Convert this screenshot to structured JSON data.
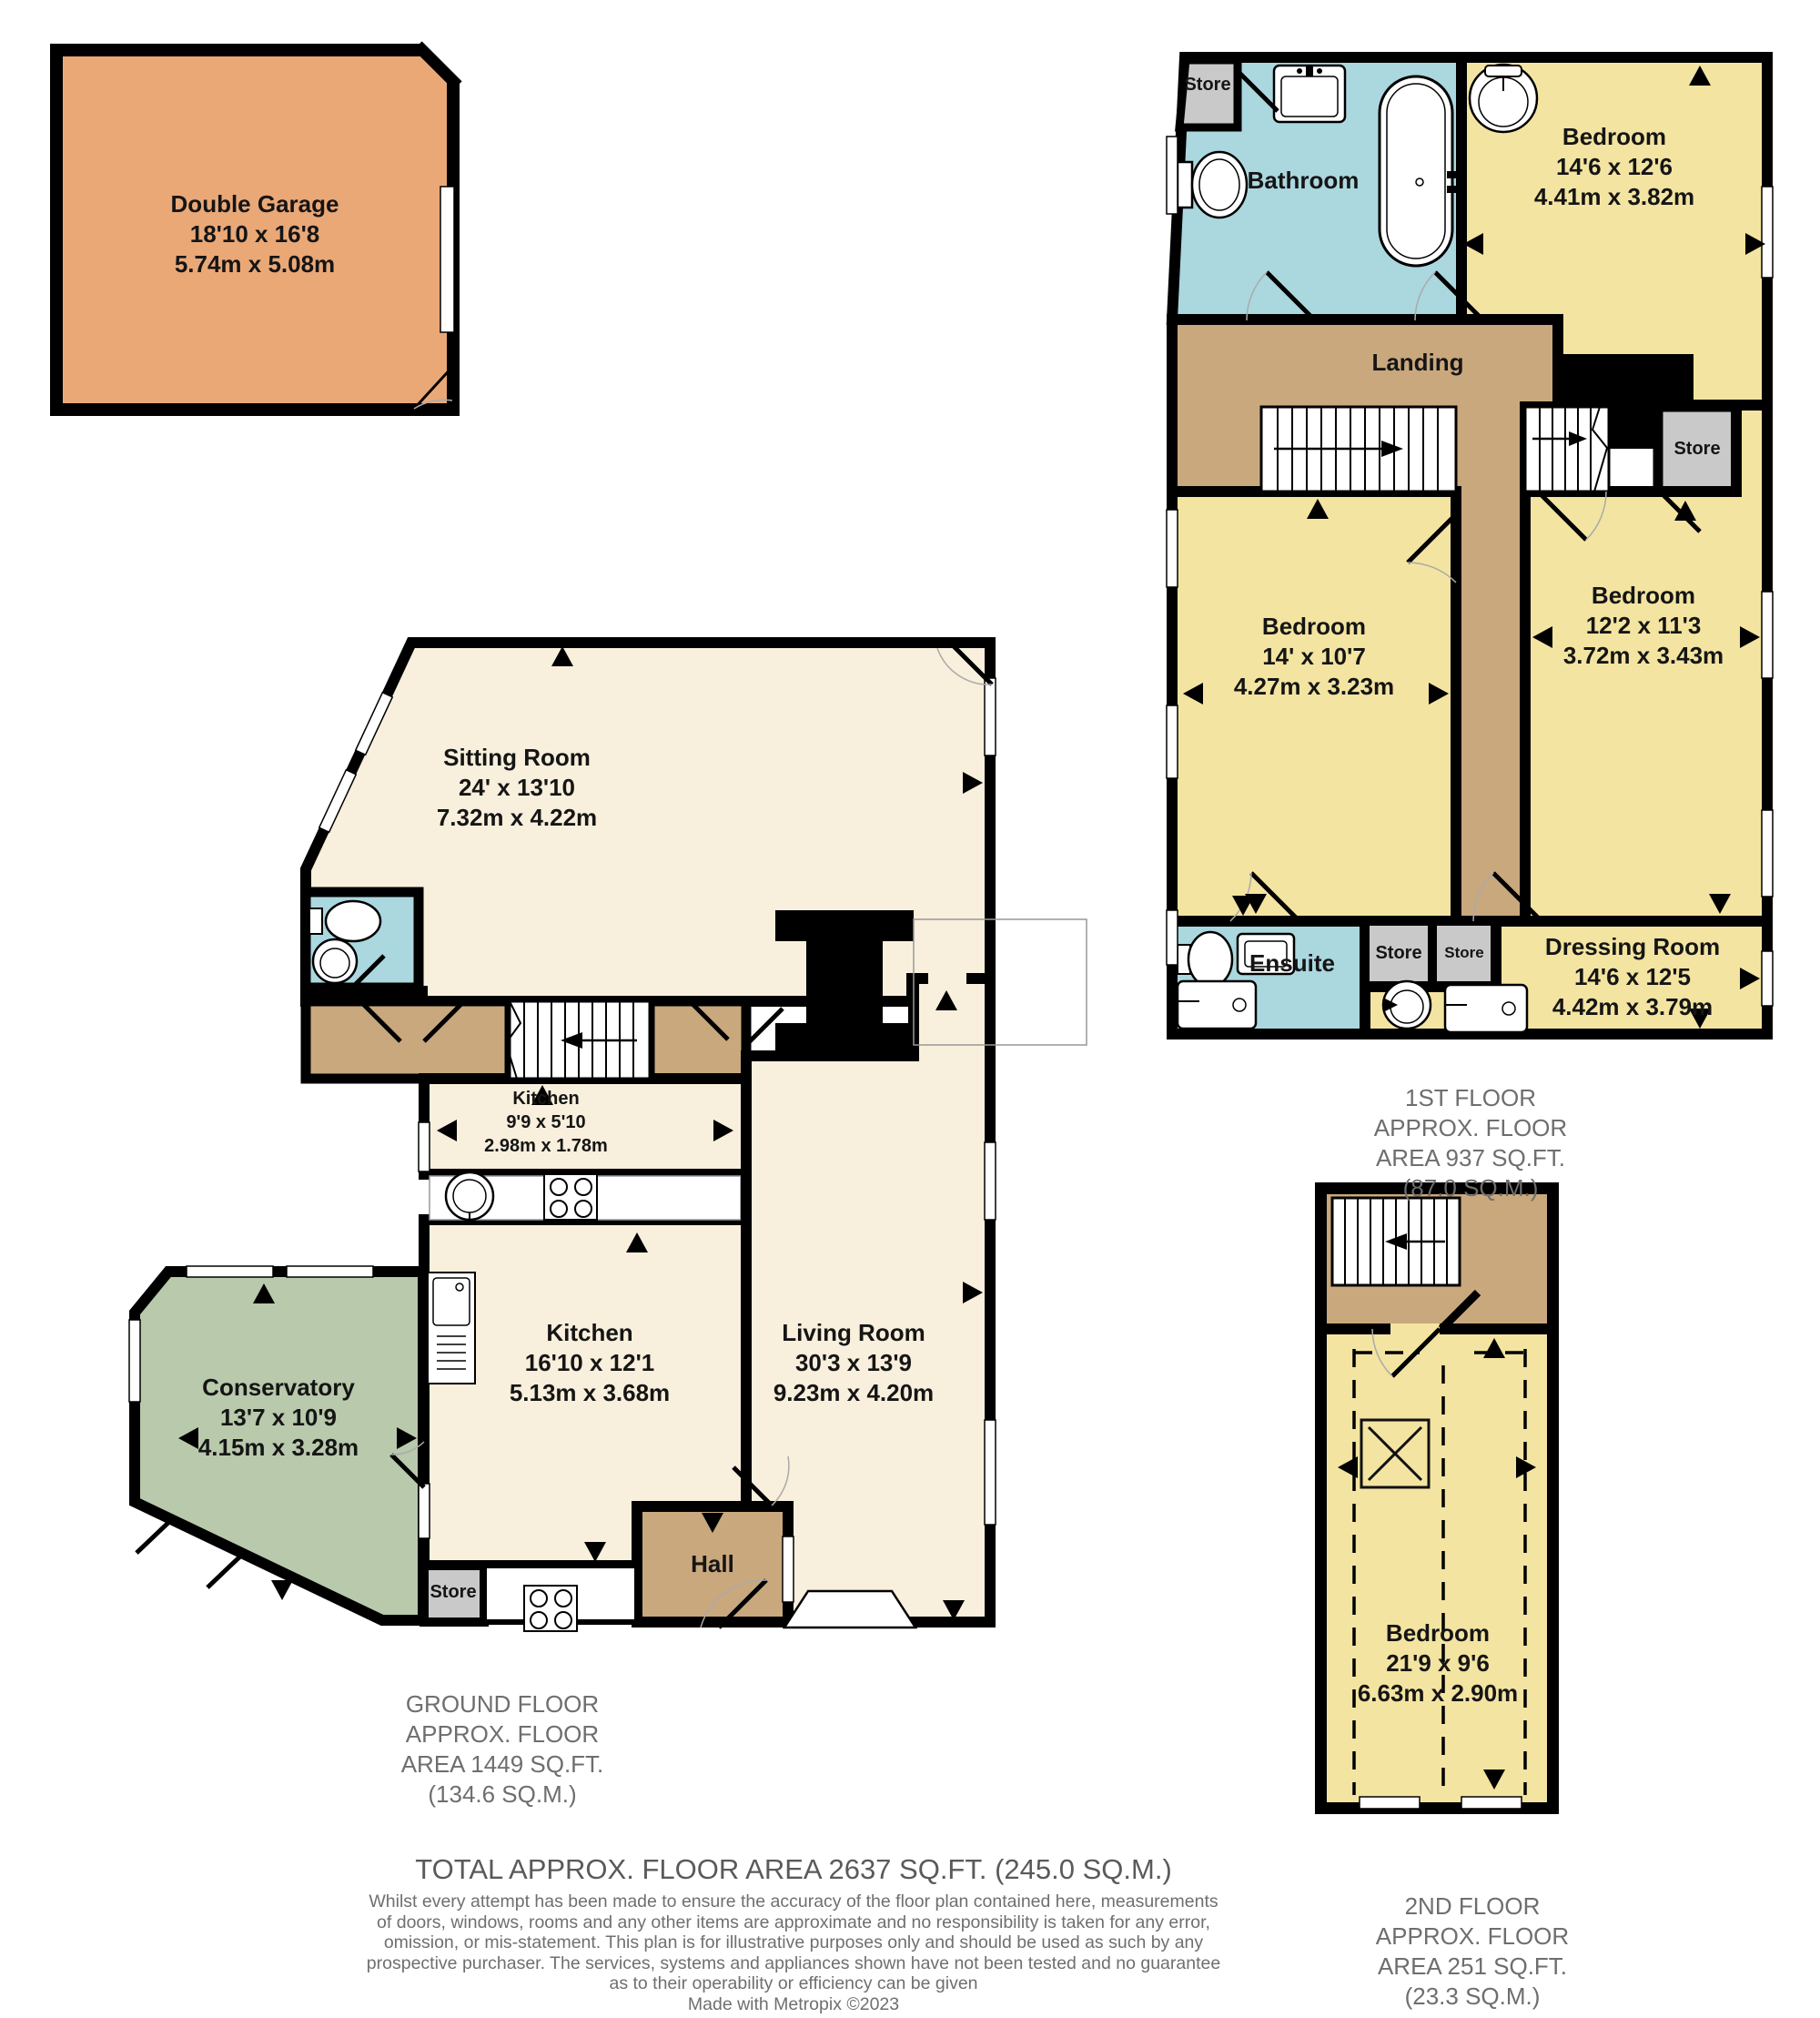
{
  "garage": {
    "name": "Double Garage",
    "imperial": "18'10 x 16'8",
    "metric": "5.74m x 5.08m"
  },
  "first_floor": {
    "caption": [
      "1ST FLOOR",
      "APPROX. FLOOR",
      "AREA 937 SQ.FT.",
      "(87.0 SQ.M.)"
    ],
    "rooms": {
      "store_top": {
        "name": "Store"
      },
      "bathroom": {
        "name": "Bathroom"
      },
      "bedroom_front": {
        "name": "Bedroom",
        "imperial": "14'6 x 12'6",
        "metric": "4.41m x 3.82m"
      },
      "landing": {
        "name": "Landing"
      },
      "store_landing": {
        "name": "Store"
      },
      "bedroom_left": {
        "name": "Bedroom",
        "imperial": "14' x 10'7",
        "metric": "4.27m x 3.23m"
      },
      "bedroom_right": {
        "name": "Bedroom",
        "imperial": "12'2 x 11'3",
        "metric": "3.72m x 3.43m"
      },
      "ensuite": {
        "name": "Ensuite"
      },
      "store_small_1": {
        "name": "Store"
      },
      "store_small_2": {
        "name": "Store"
      },
      "dressing_room": {
        "name": "Dressing Room",
        "imperial": "14'6 x 12'5",
        "metric": "4.42m x 3.79m"
      }
    }
  },
  "ground_floor": {
    "caption": [
      "GROUND FLOOR",
      "APPROX. FLOOR",
      "AREA 1449 SQ.FT.",
      "(134.6 SQ.M.)"
    ],
    "rooms": {
      "sitting_room": {
        "name": "Sitting Room",
        "imperial": "24' x 13'10",
        "metric": "7.32m x 4.22m"
      },
      "kitchen_small": {
        "name": "Kitchen",
        "imperial": "9'9 x 5'10",
        "metric": "2.98m x 1.78m"
      },
      "kitchen": {
        "name": "Kitchen",
        "imperial": "16'10 x 12'1",
        "metric": "5.13m x 3.68m"
      },
      "living_room": {
        "name": "Living Room",
        "imperial": "30'3 x 13'9",
        "metric": "9.23m x 4.20m"
      },
      "conservatory": {
        "name": "Conservatory",
        "imperial": "13'7 x 10'9",
        "metric": "4.15m x 3.28m"
      },
      "hall": {
        "name": "Hall"
      },
      "store": {
        "name": "Store"
      }
    }
  },
  "second_floor": {
    "caption": [
      "2ND FLOOR",
      "APPROX. FLOOR",
      "AREA 251 SQ.FT.",
      "(23.3 SQ.M.)"
    ],
    "rooms": {
      "bedroom": {
        "name": "Bedroom",
        "imperial": "21'9 x 9'6",
        "metric": "6.63m x 2.90m"
      }
    }
  },
  "footer": {
    "total": "TOTAL APPROX. FLOOR AREA 2637 SQ.FT. (245.0 SQ.M.)",
    "disclaimer": [
      "Whilst every attempt has been made to ensure the accuracy of the floor plan contained here, measurements",
      "of doors, windows, rooms and any other items are approximate and no responsibility is taken for any error,",
      "omission, or mis-statement. This plan is for illustrative purposes only and should be used as such by any",
      "prospective purchaser. The services, systems and appliances shown have not been tested and no guarantee",
      "as to their operability or efficiency can be given",
      "Made with Metropix ©2023"
    ]
  },
  "colors": {
    "wall": "#000000",
    "garage": "#EAA877",
    "bedroom": "#F3E4A1",
    "bath": "#ABD7DF",
    "landing": "#C9A87D",
    "store": "#C9C9C9",
    "cream": "#F8EFDC",
    "conservatory": "#B9C9AC",
    "caption_text": "#6E6E6E",
    "room_text": "#151515"
  }
}
